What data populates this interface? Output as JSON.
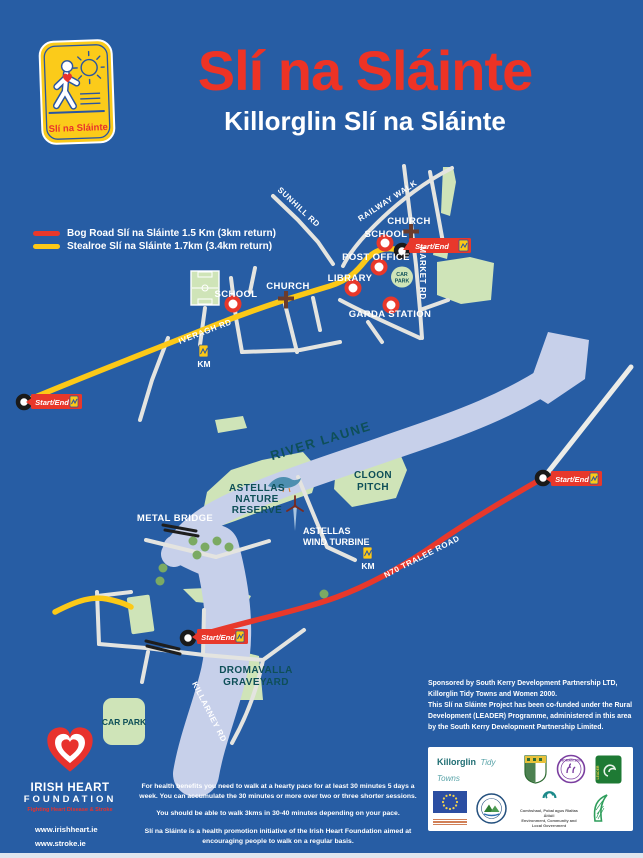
{
  "colors": {
    "background": "#275DA4",
    "title_red": "#ED3325",
    "route_red": "#E8382B",
    "route_yellow": "#FCC917",
    "park_green": "#CFE4B8",
    "river_blue": "#C7D0EA",
    "label_teal": "#0E4F58"
  },
  "header": {
    "title": "Slí na Sláinte",
    "subtitle": "Killorglin Slí na Sláinte",
    "logo_caption": "Slí na Sláinte"
  },
  "legend": {
    "items": [
      {
        "label": "Bog Road Slí na Sláinte 1.5 Km (3km return)",
        "color": "#E8382B"
      },
      {
        "label": "Stealroe Slí na Sláinte 1.7km (3.4km return)",
        "color": "#FCC917"
      }
    ]
  },
  "map": {
    "start_end_label": "Start/End",
    "km_label": "KM",
    "labels": {
      "sunhill_rd": "SUNHILL RD",
      "railway_walk": "RAILWAY WALK",
      "market_rd": "MARKET RD",
      "iveragh_rd": "IVERAGH RD",
      "n70_tralee_road": "N70 TRALEE ROAD",
      "killarney_rd": "KILLARNEY RD",
      "river_laune": "RIVER LAUNE",
      "church_town": "CHURCH",
      "school_town": "SCHOOL",
      "post_office": "POST OFFICE",
      "library": "LIBRARY",
      "garda_station": "GARDA STATION",
      "car_park_town_line1": "CAR",
      "car_park_town_line2": "PARK",
      "school_west": "SCHOOL",
      "church_west": "CHURCH",
      "metal_bridge": "METAL BRIDGE",
      "nature_reserve_line1": "ASTELLAS",
      "nature_reserve_line2": "NATURE",
      "nature_reserve_line3": "RESERVE",
      "wind_turbine_line1": "ASTELLAS",
      "wind_turbine_line2": "WIND TURBINE",
      "cloon_pitch_line1": "CLOON",
      "cloon_pitch_line2": "PITCH",
      "graveyard_line1": "DROMAVALLA",
      "graveyard_line2": "GRAVEYARD",
      "car_park_south": "CAR PARK"
    }
  },
  "footer": {
    "ihf": {
      "name_line1": "IRISH HEART",
      "name_line2": "FOUNDATION",
      "tagline": "Fighting Heart Disease & Stroke",
      "url1": "www.irishheart.ie",
      "url2": "www.stroke.ie"
    },
    "health": {
      "p1": "For health benefits you need to walk at a hearty pace for at least 30 minutes 5 days a week. You can accumulate the 30 minutes or more over two or three shorter sessions.",
      "p2": "You should be able to walk 3kms in 30-40 minutes depending on your pace.",
      "p3": "Slí na Sláinte is a health promotion initiative of the Irish Heart Foundation aimed at encouraging people to walk on a regular basis."
    },
    "sponsor": {
      "p1": "Sponsored by South Kerry Development Partnership LTD, Killorglin Tidy Towns and Women 2000.",
      "p2": "This Slí na Sláinte Project has been co-funded under the Rural Development (LEADER) Programme, administered in this area by the South Kerry Development Partnership Limited."
    },
    "logos": {
      "killorglin": "Killorglin",
      "tidy_towns": "Tidy Towns",
      "woman_2000": "WOMAN 2000",
      "leader": "LEADER",
      "env_dept_line1": "Comhshaol, Pobal agus Rialtas Áitiúil",
      "env_dept_line2": "Environment, Community and Local Government"
    }
  }
}
